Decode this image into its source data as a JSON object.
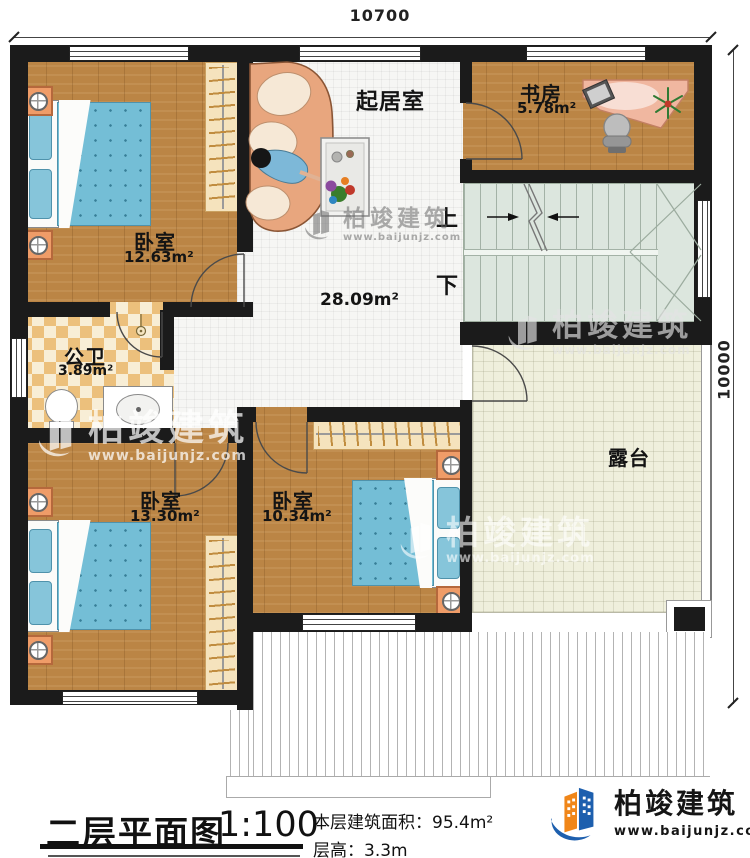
{
  "dimensions": {
    "width_top": "10700",
    "height_right": "10000"
  },
  "rooms": {
    "living_room": {
      "name": "起居室",
      "area": "28.09m²"
    },
    "study": {
      "name": "书房",
      "area": "5.78m²"
    },
    "bedroom_top_left": {
      "name": "卧室",
      "area": "12.63m²"
    },
    "bathroom": {
      "name": "公卫",
      "area": "3.89m²"
    },
    "bedroom_bottom_left": {
      "name": "卧室",
      "area": "13.30m²"
    },
    "bedroom_bottom_middle": {
      "name": "卧室",
      "area": "10.34m²"
    },
    "terrace": {
      "name": "露台"
    }
  },
  "stairs": {
    "up_label": "上",
    "down_label": "下"
  },
  "title_block": {
    "title": "二层平面图",
    "scale": "1:100",
    "floor_area_label": "本层建筑面积：",
    "floor_area_value": "95.4m²",
    "floor_height_label": "层高：",
    "floor_height_value": "3.3m"
  },
  "brand": {
    "name": "柏竣建筑",
    "website": "www.baijunjz.com"
  },
  "watermark": {
    "name": "柏竣建筑",
    "website": "www.baijunjz.com"
  },
  "colors": {
    "wall": "#1b1b1b",
    "wood_floor": "#bb8545",
    "living_tile": "#f6f6f4",
    "terrace_tile": "#efefdc",
    "stair": "#dce6de",
    "bed": "#74bed6",
    "brand_blue": "#1d5fae",
    "brand_orange": "#f08619"
  }
}
